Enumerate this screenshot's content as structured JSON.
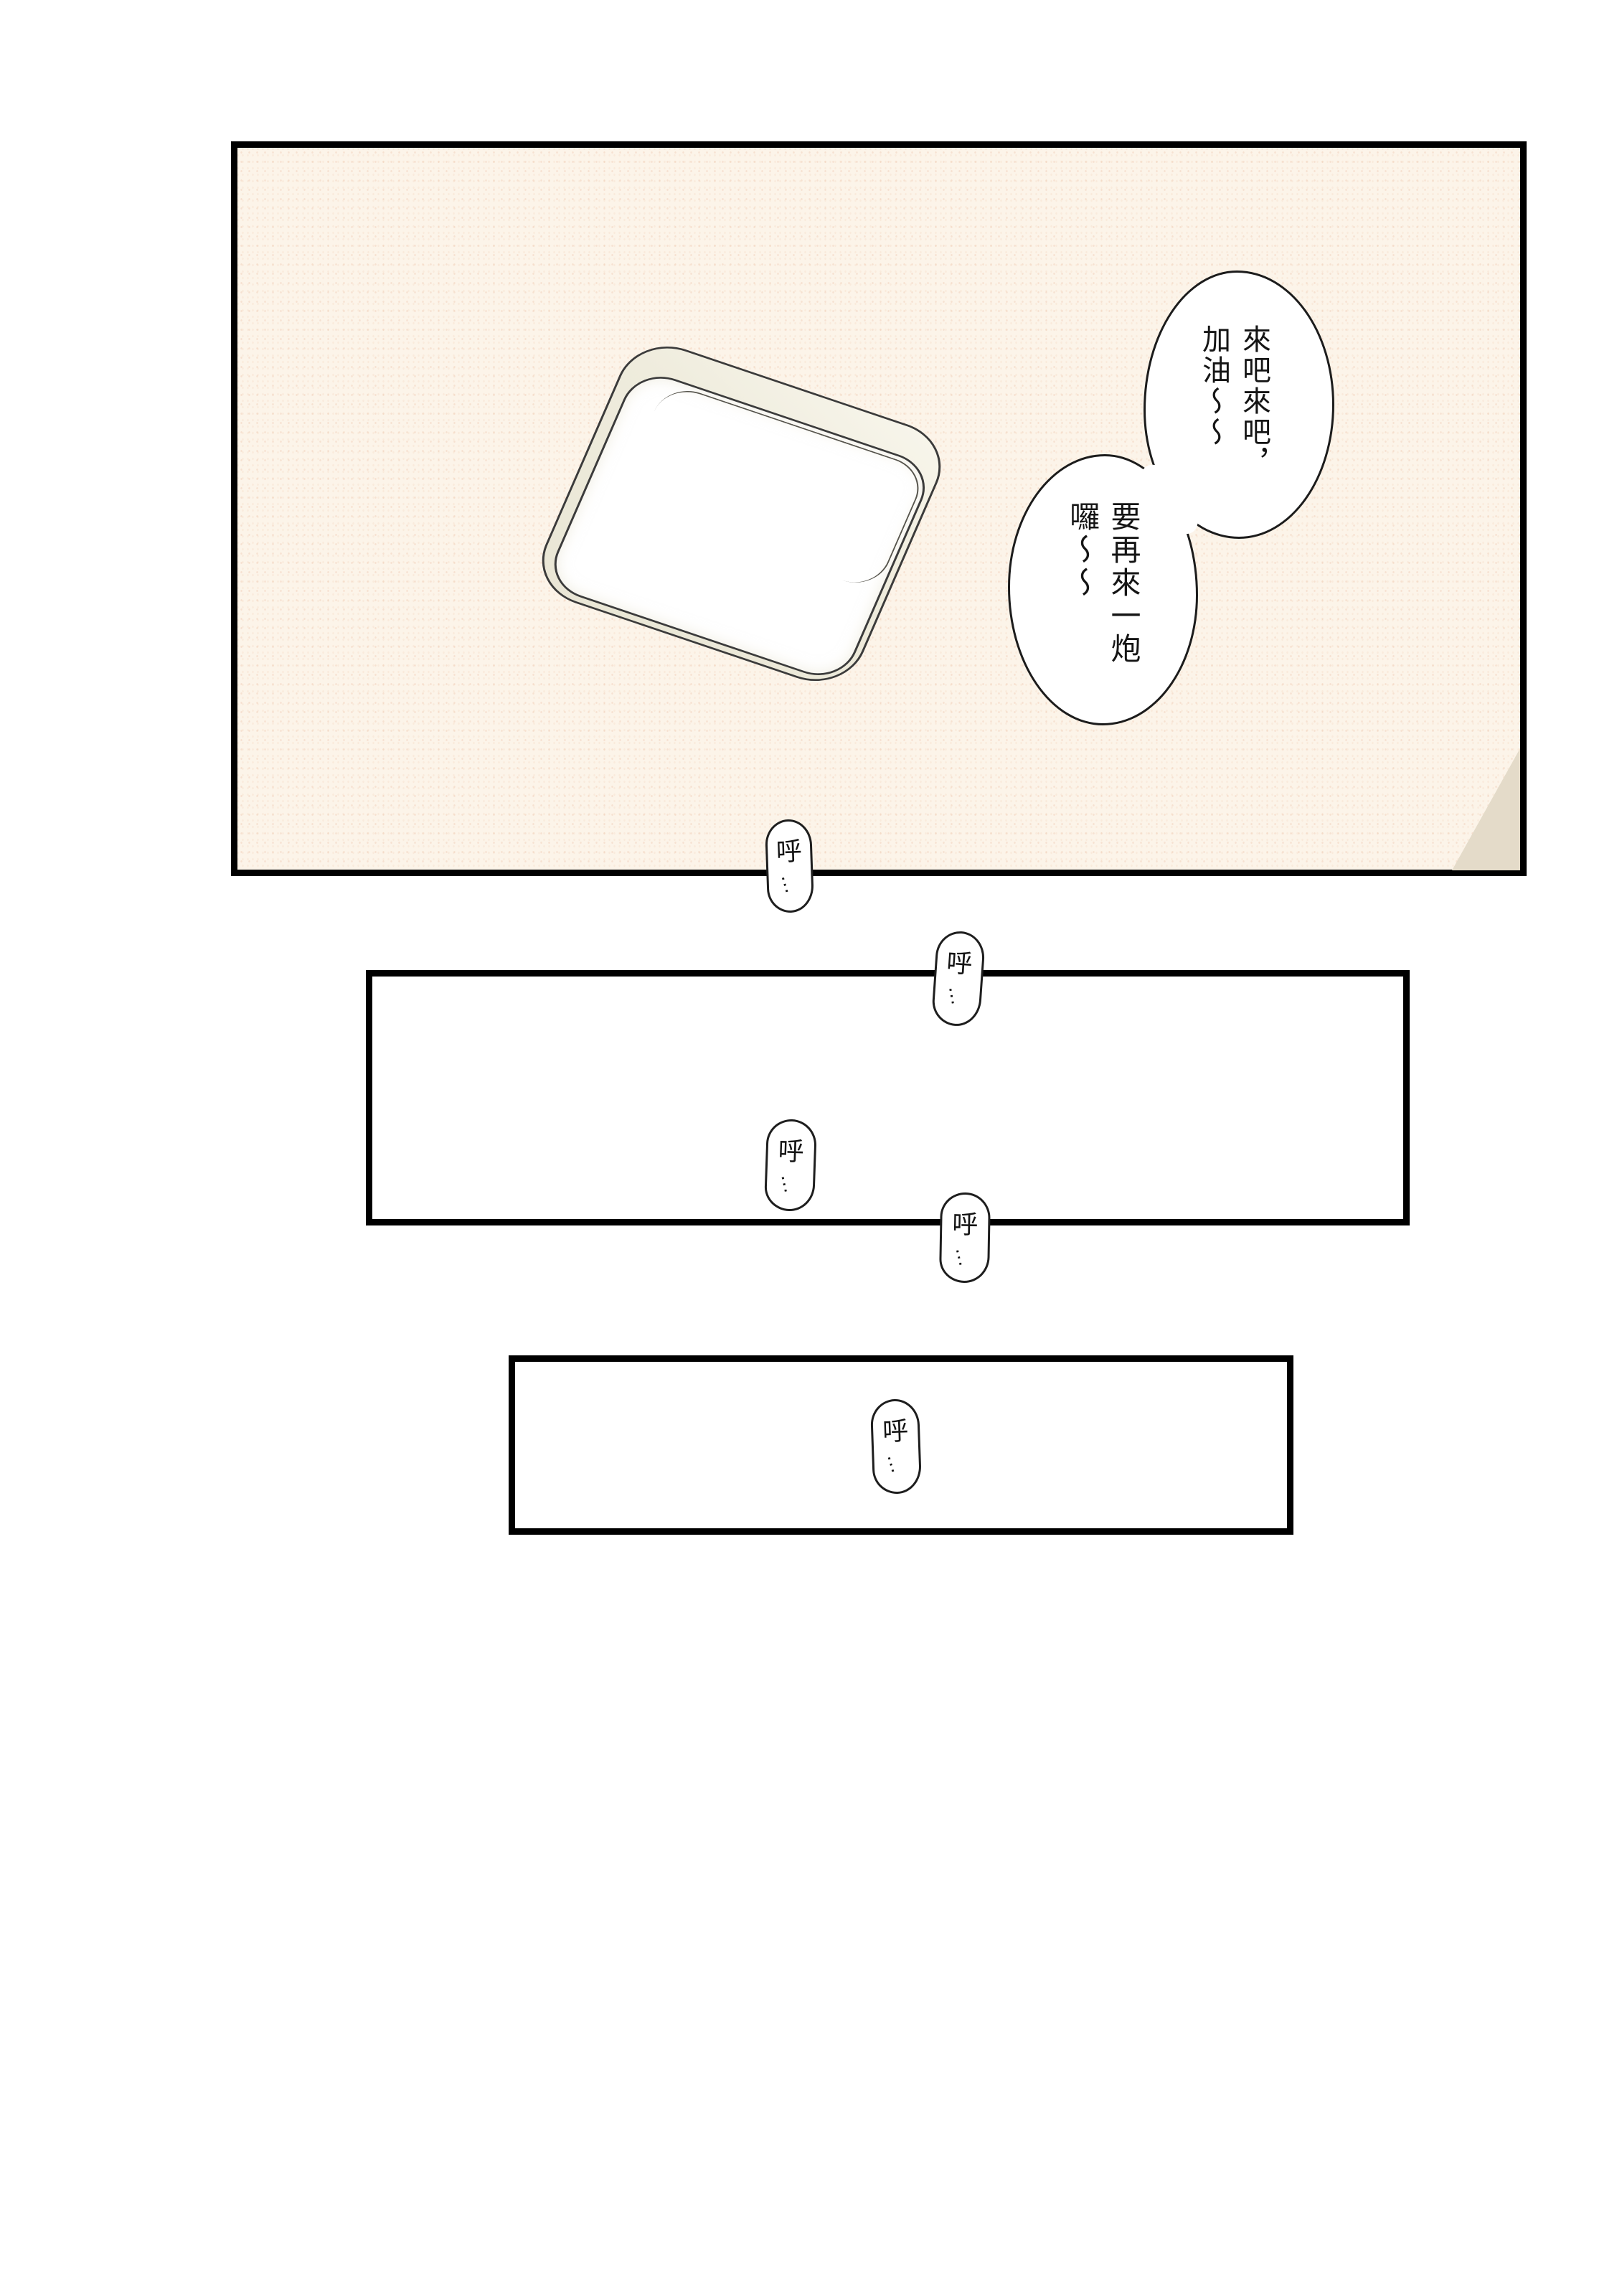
{
  "page": {
    "type": "comic-page",
    "background": "#ffffff",
    "panel_border_color": "#000000",
    "ink_color": "#151515"
  },
  "panel1": {
    "background": "#fcf4e9",
    "corner_triangle_color": "#e4dbc9",
    "light_fixture": {
      "rim_color": "#efecdd",
      "panel_color": "#ffffff",
      "outline_color": "#3b3b3b"
    }
  },
  "speech_bubbles": [
    {
      "name": "bubble-top-right",
      "columns": [
        "來吧來吧，",
        "加油～～"
      ]
    },
    {
      "name": "bubble-lower-left",
      "columns": [
        "要再來一炮",
        "囉～～"
      ]
    }
  ],
  "breath_bubbles": [
    {
      "char": "呼",
      "ellipsis": "…"
    },
    {
      "char": "呼",
      "ellipsis": "…"
    },
    {
      "char": "呼",
      "ellipsis": "…"
    },
    {
      "char": "呼",
      "ellipsis": "…"
    },
    {
      "char": "呼",
      "ellipsis": "…"
    }
  ]
}
